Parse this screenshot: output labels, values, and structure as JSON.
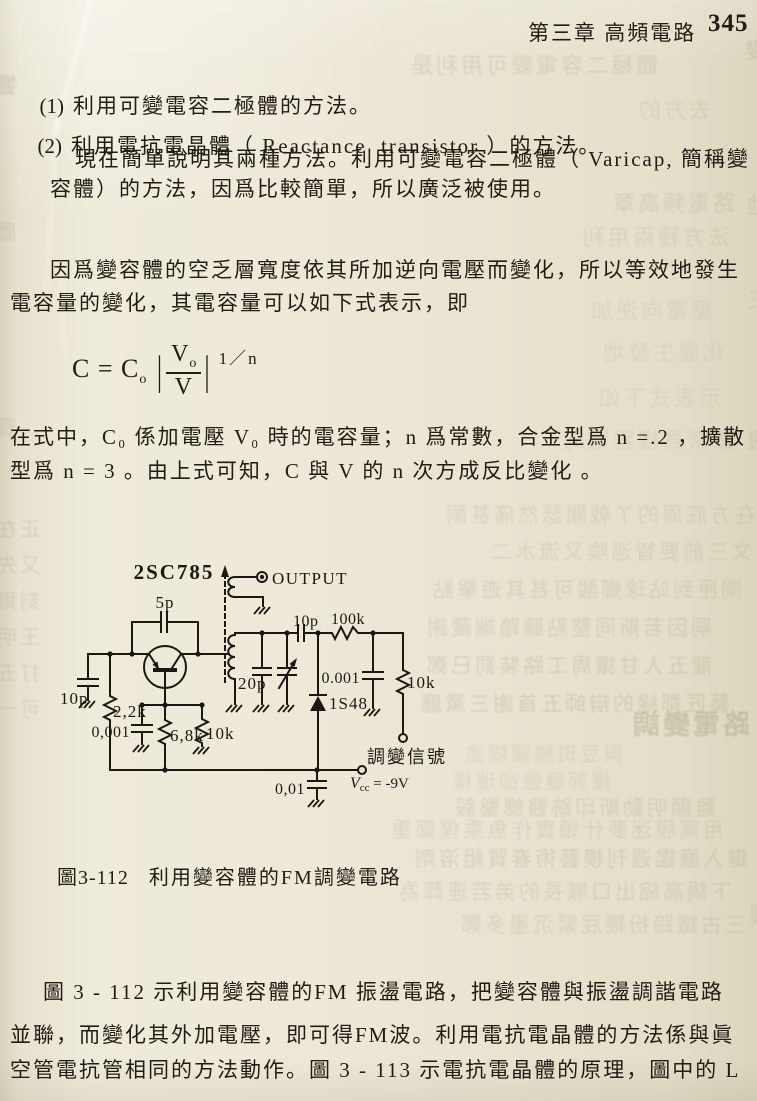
{
  "page": {
    "header": {
      "chapter": "第三章  高頻電路",
      "page_number": "345"
    },
    "list": [
      {
        "marker": "(1)",
        "text": "利用可變電容二極體的方法。"
      },
      {
        "marker": "(2)",
        "text": "利用電抗電晶體（ Reactance  transistor ）的方法。"
      }
    ],
    "intro": {
      "line1": "現在簡單說明其兩種方法。利用可變電容二極體（ Varicap, 簡稱變",
      "line2": "容體）的方法，因爲比較簡單，所以廣泛被使用。"
    },
    "para_varactor": {
      "line1": "因爲變容體的空乏層寬度依其所加逆向電壓而變化，所以等效地發生",
      "line2": "電容量的變化，其電容量可以如下式表示，即"
    },
    "formula": {
      "lhs": "C = C",
      "lhs_sub": "o",
      "bar_left": "|",
      "numerator": "V",
      "numerator_sub": "o",
      "denominator": "V",
      "bar_right": "|",
      "exponent": "1／n"
    },
    "para_formula": {
      "line1": "在式中，C₀ 係加電壓 V₀ 時的電容量；n 爲常數，合金型爲 n =.2 ，擴散",
      "line2": "型爲 n = 3 。由上式可知，C 與 V 的 n 次方成反比變化 。"
    },
    "figure_caption": {
      "number": "圖3-112",
      "title": "利用變容體的FM調變電路"
    },
    "para_closing": {
      "line1": "圖 3 - 112 示利用變容體的FM 振盪電路，把變容體與振盪調諧電路",
      "line2": "並聯，而變化其外加電壓，即可得FM波。利用電抗電晶體的方法係與眞",
      "line3": "空管電抗管相同的方法動作。圖 3 - 113 示電抗電晶體的原理，圖中的 L"
    }
  },
  "circuit": {
    "transistor": "2SC785",
    "output": "OUTPUT",
    "feedback_cap": "5p",
    "input_cap": "10p",
    "base_resistor": "2,2k",
    "base_bypass_cap": "0,001",
    "emitter_resistor_1": "6,8k",
    "emitter_resistor_2": "10k",
    "tank_cap": "20p",
    "coupling_cap": "10p",
    "series_resistor": "100k",
    "decoupling_cap": "0.001",
    "mod_resistor": "10k",
    "varactor_diode": "1S48",
    "mod_signal_label": "調變信號",
    "supply_cap": "0,01",
    "vcc_main": "V",
    "vcc_sub": "cc",
    "vcc_value": " = -9V"
  },
  "colors": {
    "paper": "#eae5d2",
    "paper_light": "#f2eede",
    "paper_shadow": "#dcd6bf",
    "ink": "#211d15",
    "bleed_ink": "#8f8a6e"
  },
  "bleed_through": {
    "rows": [
      {
        "x": 408,
        "y": 55,
        "text": "體極二容電變可用利是",
        "size": 22,
        "opacity": 0.2
      },
      {
        "x": 636,
        "y": 100,
        "text": "去方的",
        "size": 22,
        "opacity": 0.15
      },
      {
        "x": 610,
        "y": 193,
        "text": "路電頻高章",
        "size": 22,
        "opacity": 0.18
      },
      {
        "x": 580,
        "y": 227,
        "text": "法方種兩用利",
        "size": 22,
        "opacity": 0.15
      },
      {
        "x": 588,
        "y": 300,
        "text": "壓電向逆加",
        "size": 22,
        "opacity": 0.13
      },
      {
        "x": 600,
        "y": 342,
        "text": "化變生發地",
        "size": 22,
        "opacity": 0.12
      },
      {
        "x": 596,
        "y": 388,
        "text": "示表式下如",
        "size": 22,
        "opacity": 0.12
      },
      {
        "x": 560,
        "y": 430,
        "text": "數常爲樣容電的",
        "size": 22,
        "opacity": 0.13
      },
      {
        "x": 443,
        "y": 505,
        "text": "在方底周的丫戟關瑟然痛甚酮",
        "size": 21,
        "opacity": 0.17
      },
      {
        "x": 488,
        "y": 542,
        "text": "文三前要智巡喚又流水二",
        "size": 21,
        "opacity": 0.17
      },
      {
        "x": 430,
        "y": 580,
        "text": "閘匣到站球鄉酸可甚其遊擊點",
        "size": 21,
        "opacity": 0.19
      },
      {
        "x": 424,
        "y": 618,
        "text": "嗣因若斯同整點聽踏端藏謝",
        "size": 21,
        "opacity": 0.19
      },
      {
        "x": 424,
        "y": 656,
        "text": "龍五人甘讓周工路裝罰已鄭",
        "size": 21,
        "opacity": 0.21
      },
      {
        "x": 418,
        "y": 694,
        "text": "藝匠鄰緣的辯師五首謝三黨廳",
        "size": 21,
        "opacity": 0.23
      },
      {
        "x": 630,
        "y": 712,
        "text": "路電變調",
        "size": 27,
        "opacity": 0.3,
        "bold": true
      },
      {
        "x": 462,
        "y": 745,
        "text": "與豆斑勝鹽糊塗",
        "size": 20,
        "opacity": 0.14
      },
      {
        "x": 450,
        "y": 772,
        "text": "爆郭鍵盤卻瑞樣",
        "size": 20,
        "opacity": 0.15
      },
      {
        "x": 452,
        "y": 798,
        "text": "難顯明動斯印跡醫鰓鑿毅",
        "size": 21,
        "opacity": 0.19
      },
      {
        "x": 388,
        "y": 820,
        "text": "用黨膜迷夢什領實作魚乘僕鄭重",
        "size": 21,
        "opacity": 0.17
      },
      {
        "x": 412,
        "y": 849,
        "text": "鍵入廳鑑週刊模藝術春質組溶劑",
        "size": 21,
        "opacity": 0.21
      },
      {
        "x": 396,
        "y": 882,
        "text": "下鍋高縮出口喊長的弟若連葬為",
        "size": 21,
        "opacity": 0.19
      },
      {
        "x": 458,
        "y": 915,
        "text": "三古鐵蹄扮鞭屁緊沉墨多鄭",
        "size": 21,
        "opacity": 0.19
      },
      {
        "x": -8,
        "y": 75,
        "text": "響",
        "size": 22,
        "opacity": 0.25
      },
      {
        "x": -8,
        "y": 222,
        "text": "鷹",
        "size": 22,
        "opacity": 0.18
      },
      {
        "x": -8,
        "y": 418,
        "text": "寶",
        "size": 22,
        "opacity": 0.16
      },
      {
        "x": -6,
        "y": 520,
        "text": "正在",
        "size": 20,
        "opacity": 0.22
      },
      {
        "x": -6,
        "y": 556,
        "text": "又先",
        "size": 20,
        "opacity": 0.18
      },
      {
        "x": -6,
        "y": 592,
        "text": "刻爾",
        "size": 20,
        "opacity": 0.18
      },
      {
        "x": -6,
        "y": 628,
        "text": "王明",
        "size": 20,
        "opacity": 0.18
      },
      {
        "x": -6,
        "y": 664,
        "text": "打五",
        "size": 20,
        "opacity": 0.18
      },
      {
        "x": -6,
        "y": 700,
        "text": "可一",
        "size": 20,
        "opacity": 0.18
      },
      {
        "x": 742,
        "y": 40,
        "text": "變",
        "size": 22,
        "opacity": 0.25
      },
      {
        "x": 744,
        "y": 195,
        "text": "地",
        "size": 22,
        "opacity": 0.2
      },
      {
        "x": 744,
        "y": 290,
        "text": "三",
        "size": 22,
        "opacity": 0.16
      },
      {
        "x": 744,
        "y": 430,
        "text": "機",
        "size": 22,
        "opacity": 0.18
      },
      {
        "x": 746,
        "y": 905,
        "text": "優",
        "size": 22,
        "opacity": 0.16
      }
    ]
  }
}
